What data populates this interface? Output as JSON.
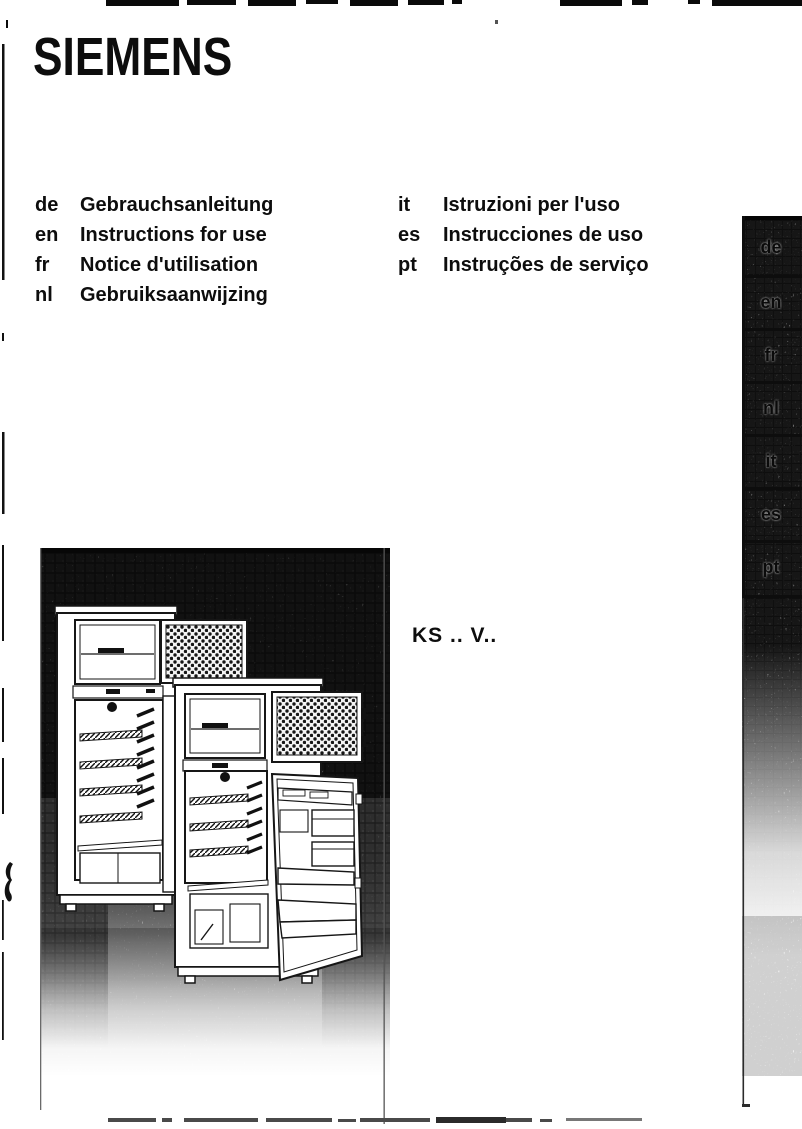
{
  "page": {
    "brand": "SIEMENS",
    "model_code": "KS .. V.."
  },
  "languages": {
    "left": [
      {
        "code": "de",
        "label": "Gebrauchsanleitung"
      },
      {
        "code": "en",
        "label": "Instructions for use"
      },
      {
        "code": "fr",
        "label": "Notice d'utilisation"
      },
      {
        "code": "nl",
        "label": "Gebruiksaanwijzing"
      }
    ],
    "right": [
      {
        "code": "it",
        "label": "Istruzioni per l'uso"
      },
      {
        "code": "es",
        "label": "Instrucciones de uso"
      },
      {
        "code": "pt",
        "label": "Instruções de serviço"
      }
    ]
  },
  "sidebar_tabs": [
    "de",
    "en",
    "fr",
    "nl",
    "it",
    "es",
    "pt"
  ],
  "illustration": {
    "description": "Two top-freezer refrigerators with open doors shown against a dark halftone background"
  },
  "colors": {
    "ink": "#0d0d0d",
    "paper": "#ffffff",
    "illustration_background": "#565656",
    "sidebar_gray": "#989898"
  }
}
